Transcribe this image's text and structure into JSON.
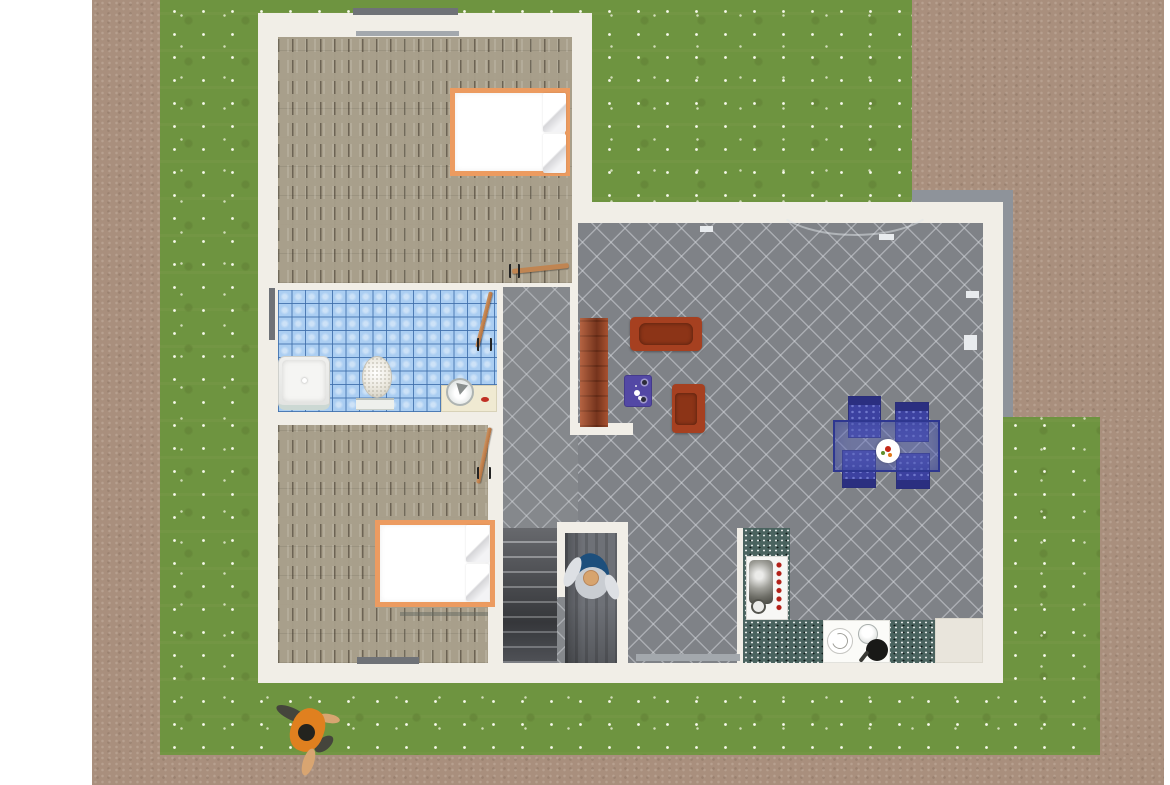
{
  "meta": {
    "view": "overhead-3d-home-plan-render",
    "canvas_width": 1170,
    "canvas_height": 785
  },
  "palette": {
    "grass": "#6e9440",
    "dirt_path": "#a98f7d",
    "house_wall": "#f1eee7",
    "wood_floor": "#a89f8b",
    "bath_tile": "#abcef2",
    "living_tile": "#7f8287",
    "counter_granite": "#4a635f",
    "sofa_red": "#a64020",
    "dining_blue": "#3c41a0",
    "bed_frame_orange": "#ec9b60",
    "terrace_gray": "#8e939a"
  },
  "rooms": [
    {
      "name": "bedroom-top",
      "floor": "wood"
    },
    {
      "name": "bathroom",
      "floor": "blue-tile"
    },
    {
      "name": "bedroom-bottom",
      "floor": "wood"
    },
    {
      "name": "hallway-stairwell",
      "floor": "gray-tile"
    },
    {
      "name": "living-dining-kitchen",
      "floor": "gray-tile"
    }
  ],
  "scene": {
    "elements": [
      {
        "name": "lawn",
        "cls": "grass",
        "rect": [
          160,
          0,
          940,
          755
        ]
      },
      {
        "name": "dirt-path-left",
        "cls": "dirt",
        "rect": [
          92,
          0,
          68,
          785
        ]
      },
      {
        "name": "dirt-yard-top-right",
        "cls": "dirt",
        "rect": [
          912,
          0,
          252,
          417
        ]
      },
      {
        "name": "dirt-path-right",
        "cls": "dirt",
        "rect": [
          1100,
          417,
          64,
          368
        ]
      },
      {
        "name": "dirt-path-bottom",
        "cls": "dirt",
        "rect": [
          92,
          755,
          1072,
          30
        ]
      },
      {
        "name": "terrace-border-top",
        "cls": "gray-band",
        "rect": [
          912,
          190,
          101,
          12
        ]
      },
      {
        "name": "terrace-border-right",
        "cls": "gray-band",
        "rect": [
          1001,
          190,
          12,
          227
        ]
      },
      {
        "name": "house-left-wing",
        "cls": "wall",
        "rect": [
          258,
          13,
          334,
          670
        ]
      },
      {
        "name": "house-right-wing",
        "cls": "wall",
        "rect": [
          572,
          202,
          431,
          481
        ]
      },
      {
        "name": "bedroom-top-floor",
        "cls": "wood",
        "rect": [
          278,
          37,
          294,
          246
        ]
      },
      {
        "name": "bathroom-floor",
        "cls": "bathtile",
        "rect": [
          278,
          290,
          219,
          122
        ]
      },
      {
        "name": "bedroom-bottom-floor",
        "cls": "wood",
        "rect": [
          278,
          425,
          210,
          238
        ]
      },
      {
        "name": "hallway-floor",
        "cls": "tile2",
        "rect": [
          503,
          287,
          75,
          376
        ]
      },
      {
        "name": "living-room-floor",
        "cls": "tile",
        "rect": [
          578,
          223,
          405,
          440
        ]
      },
      {
        "name": "wall-hall-living",
        "cls": "wall",
        "rect": [
          570,
          287,
          8,
          148
        ]
      },
      {
        "name": "wall-living-stub",
        "cls": "wall",
        "rect": [
          570,
          423,
          63,
          12
        ]
      },
      {
        "name": "terrace-door-arc",
        "cls": "arc",
        "rect": [
          770,
          160,
          170,
          76
        ]
      },
      {
        "name": "staircase",
        "cls": "stairs",
        "rect": [
          503,
          528,
          54,
          135
        ]
      },
      {
        "name": "stairwell-landing",
        "cls": "corridor",
        "rect": [
          565,
          533,
          52,
          130
        ]
      },
      {
        "name": "stairwell-wall-top",
        "cls": "wall",
        "rect": [
          557,
          522,
          71,
          11
        ]
      },
      {
        "name": "stairwell-wall-left",
        "cls": "wall",
        "rect": [
          557,
          533,
          8,
          64
        ]
      },
      {
        "name": "stairwell-wall-right",
        "cls": "wall",
        "rect": [
          617,
          522,
          11,
          141
        ]
      },
      {
        "name": "kitchen-wall-sliver",
        "cls": "wall",
        "rect": [
          737,
          528,
          6,
          135
        ]
      },
      {
        "name": "kitchen-counter-left",
        "cls": "teal",
        "rect": [
          743,
          528,
          47,
          135
        ]
      },
      {
        "name": "kitchen-fridge",
        "cls": "appliance",
        "rect": [
          746,
          556,
          42,
          64
        ]
      },
      {
        "name": "kitchen-fridge-ring",
        "cls": "ring",
        "rect": [
          751,
          599,
          15,
          15
        ]
      },
      {
        "name": "kitchen-counter-bottom",
        "cls": "teal",
        "rect": [
          743,
          620,
          192,
          43
        ]
      },
      {
        "name": "kitchen-sink-section",
        "cls": "sinkzone",
        "rect": [
          823,
          620,
          67,
          43
        ]
      },
      {
        "name": "kitchen-plate",
        "cls": "plate2",
        "rect": [
          827,
          628,
          26,
          26
        ]
      },
      {
        "name": "kitchen-pot",
        "cls": "pot",
        "rect": [
          858,
          624,
          20,
          20
        ]
      },
      {
        "name": "kitchen-pan",
        "cls": "pan",
        "rect": [
          866,
          639,
          22,
          22
        ]
      },
      {
        "name": "kitchen-island",
        "cls": "beige",
        "rect": [
          935,
          618,
          48,
          45
        ]
      },
      {
        "name": "bookcase",
        "cls": "bookcase",
        "rect": [
          580,
          318,
          28,
          109
        ]
      },
      {
        "name": "sofa",
        "cls": "sofa",
        "rect": [
          630,
          317,
          72,
          34
        ]
      },
      {
        "name": "coffee-table",
        "cls": "ctable",
        "rect": [
          624,
          375,
          28,
          32
        ]
      },
      {
        "name": "armchair",
        "cls": "armchair",
        "rect": [
          672,
          384,
          33,
          49
        ]
      },
      {
        "name": "dining-chair-1",
        "cls": "dchair",
        "rect": [
          848,
          396,
          33,
          42
        ]
      },
      {
        "name": "dining-chair-2",
        "cls": "dchair",
        "rect": [
          895,
          402,
          34,
          40
        ]
      },
      {
        "name": "dining-chair-3",
        "cls": "dchair flip",
        "rect": [
          842,
          450,
          34,
          38
        ]
      },
      {
        "name": "dining-chair-4",
        "cls": "dchair flip",
        "rect": [
          896,
          453,
          34,
          36
        ]
      },
      {
        "name": "dining-table",
        "cls": "dtable",
        "rect": [
          833,
          420,
          107,
          52
        ]
      },
      {
        "name": "fruit-plate",
        "cls": "plate",
        "rect": [
          876,
          439,
          24,
          24
        ]
      },
      {
        "name": "bed-top",
        "cls": "bed",
        "rect": [
          450,
          88,
          120,
          88
        ]
      },
      {
        "name": "bed-top-pillow-1",
        "cls": "pillow",
        "rect": [
          543,
          93,
          23,
          39
        ]
      },
      {
        "name": "bed-top-pillow-2",
        "cls": "pillow",
        "rect": [
          543,
          134,
          23,
          39
        ]
      },
      {
        "name": "bed-bottom",
        "cls": "bed",
        "rect": [
          375,
          520,
          120,
          87
        ]
      },
      {
        "name": "bed-bottom-pillow-1",
        "cls": "pillow",
        "rect": [
          466,
          525,
          23,
          37
        ]
      },
      {
        "name": "bed-bottom-pillow-2",
        "cls": "pillow",
        "rect": [
          466,
          564,
          23,
          37
        ]
      },
      {
        "name": "bed-bottom-shadow",
        "cls": "shadowline",
        "rect": [
          400,
          612,
          88,
          4
        ]
      },
      {
        "name": "shower",
        "cls": "shower",
        "rect": [
          278,
          356,
          52,
          54
        ]
      },
      {
        "name": "toilet",
        "cls": "toilet",
        "rect": [
          362,
          356,
          30,
          42
        ]
      },
      {
        "name": "toilet-base",
        "cls": "toiletbase",
        "rect": [
          356,
          398,
          38,
          12
        ]
      },
      {
        "name": "sink-counter",
        "cls": "sinkcounter",
        "rect": [
          441,
          385,
          56,
          27
        ]
      },
      {
        "name": "sink-bowl",
        "cls": "sinkbowl",
        "rect": [
          446,
          378,
          28,
          28
        ]
      },
      {
        "name": "soap-dish",
        "cls": "soap",
        "rect": [
          481,
          397,
          8,
          5
        ]
      },
      {
        "name": "window-bedroom-top-outer",
        "cls": "winbar",
        "rect": [
          353,
          8,
          105,
          7
        ]
      },
      {
        "name": "window-bedroom-top-inner",
        "cls": "winbar-light",
        "rect": [
          356,
          31,
          103,
          5
        ]
      },
      {
        "name": "window-bathroom-left",
        "cls": "winbar",
        "rect": [
          269,
          288,
          6,
          52
        ]
      },
      {
        "name": "window-bedroom-bottom",
        "cls": "winbar",
        "rect": [
          357,
          657,
          62,
          7
        ]
      },
      {
        "name": "window-living-bottom",
        "cls": "winbar-light",
        "rect": [
          636,
          654,
          104,
          7
        ]
      },
      {
        "name": "window-crank-1",
        "cls": "crank",
        "rect": [
          700,
          226,
          13,
          6
        ]
      },
      {
        "name": "window-crank-2",
        "cls": "crank",
        "rect": [
          879,
          234,
          15,
          6
        ]
      },
      {
        "name": "window-crank-3",
        "cls": "crank",
        "rect": [
          966,
          291,
          13,
          7
        ]
      },
      {
        "name": "window-crank-4",
        "cls": "crank",
        "rect": [
          964,
          335,
          13,
          15
        ]
      },
      {
        "name": "door-bedroom-top-leaf",
        "cls": "doorleaf",
        "rect": [
          512,
          266,
          57,
          5
        ],
        "rot": -6
      },
      {
        "name": "door-bedroom-top-handle",
        "cls": "handle",
        "rect": [
          509,
          264,
          11,
          14
        ]
      },
      {
        "name": "door-bathroom-leaf",
        "cls": "doorleaf-v",
        "rect": [
          482,
          291,
          4,
          57
        ],
        "rot": 14
      },
      {
        "name": "door-bathroom-handle",
        "cls": "handle",
        "rect": [
          477,
          338,
          15,
          13
        ]
      },
      {
        "name": "door-bedroom-bottom-leaf",
        "cls": "doorleaf-v",
        "rect": [
          482,
          427,
          4,
          57
        ],
        "rot": 12
      },
      {
        "name": "door-bedroom-bottom-handle",
        "cls": "handle",
        "rect": [
          477,
          467,
          14,
          12
        ]
      },
      {
        "name": "person-inside-shadow",
        "cls": "p-shadow",
        "rect": [
          575,
          553,
          34,
          42
        ],
        "rot": -15
      },
      {
        "name": "person-inside-arm-left",
        "cls": "p-arm",
        "rect": [
          566,
          556,
          13,
          32
        ],
        "rot": 25
      },
      {
        "name": "person-inside-torso",
        "cls": "p-torso",
        "rect": [
          575,
          567,
          34,
          32
        ],
        "rot": -10
      },
      {
        "name": "person-inside-arm-right",
        "cls": "p-arm",
        "rect": [
          606,
          574,
          12,
          26
        ],
        "rot": -20
      },
      {
        "name": "person-inside-head",
        "cls": "p-head",
        "rect": [
          583,
          570,
          16,
          16
        ]
      },
      {
        "name": "person-outside-arm",
        "cls": "p-limb",
        "rect": [
          275,
          708,
          34,
          12
        ],
        "rot": 25
      },
      {
        "name": "person-outside-sleeve",
        "cls": "p-limb",
        "rect": [
          313,
          738,
          22,
          12
        ],
        "rot": -40
      },
      {
        "name": "person-outside-arm-skin",
        "cls": "p-skin",
        "rect": [
          318,
          714,
          22,
          9
        ],
        "rot": 10
      },
      {
        "name": "person-outside-shirt",
        "cls": "p-shirt",
        "rect": [
          291,
          708,
          33,
          44
        ],
        "rot": 20
      },
      {
        "name": "person-outside-head",
        "cls": "p-dark",
        "rect": [
          298,
          724,
          17,
          17
        ]
      },
      {
        "name": "person-outside-leg",
        "cls": "p-skinleg",
        "rect": [
          303,
          748,
          11,
          28
        ],
        "rot": 18
      }
    ]
  }
}
